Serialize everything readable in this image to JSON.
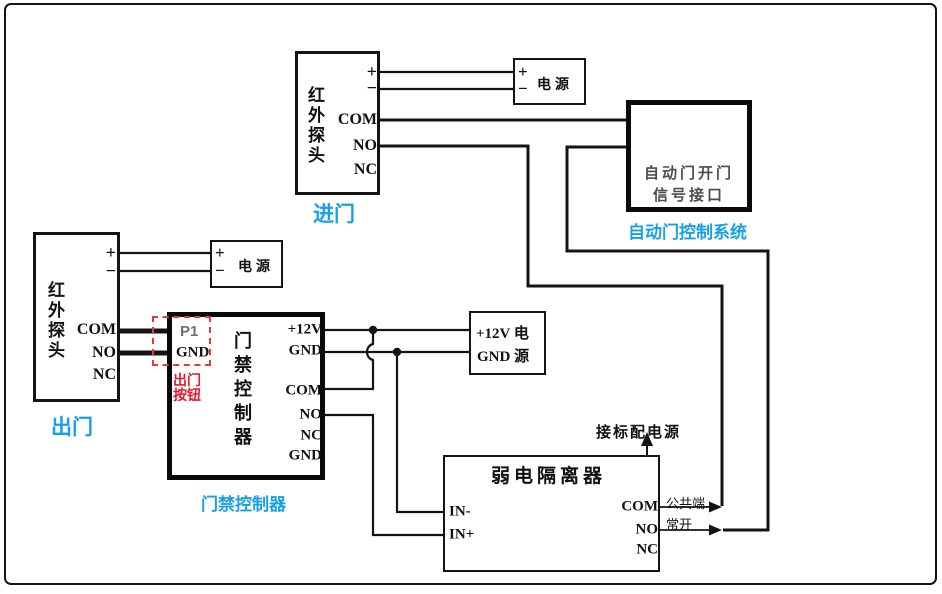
{
  "colors": {
    "wire": "#141414",
    "cyan": "#18a0e6",
    "red": "#e8192c",
    "gray": "#555555"
  },
  "entry_sensor": {
    "title": "红外探头",
    "t_plus": "+",
    "t_minus": "−",
    "t_com": "COM",
    "t_no": "NO",
    "t_nc": "NC",
    "label": "进门"
  },
  "entry_power": {
    "t_plus": "+",
    "t_minus": "−",
    "title": "电源"
  },
  "auto_door": {
    "line1": "自动门开门",
    "line2": "信号接口",
    "label": "自动门控制系统"
  },
  "exit_sensor": {
    "title": "红外探头",
    "t_plus": "+",
    "t_minus": "−",
    "t_com": "COM",
    "t_no": "NO",
    "t_nc": "NC",
    "label": "出门"
  },
  "exit_power": {
    "t_plus": "+",
    "t_minus": "−",
    "title": "电源"
  },
  "controller": {
    "p1": "P1",
    "gnd": "GND",
    "exit_btn_line1": "出门",
    "exit_btn_line2": "按钮",
    "title": "门禁控制器",
    "t_12v": "+12V",
    "t_gnd": "GND",
    "t_com": "COM",
    "t_no": "NO",
    "t_nc": "NC",
    "t_gnd2": "GND",
    "label": "门禁控制器"
  },
  "dc_power": {
    "row1": "+12V 电",
    "row2": "GND 源"
  },
  "isolator": {
    "title": "弱电隔离器",
    "t_in_minus": "IN-",
    "t_in_plus": "IN+",
    "t_com": "COM",
    "t_no": "NO",
    "t_nc": "NC",
    "power_note": "接标配电源",
    "com_tag": "公共端",
    "no_tag": "常开"
  }
}
